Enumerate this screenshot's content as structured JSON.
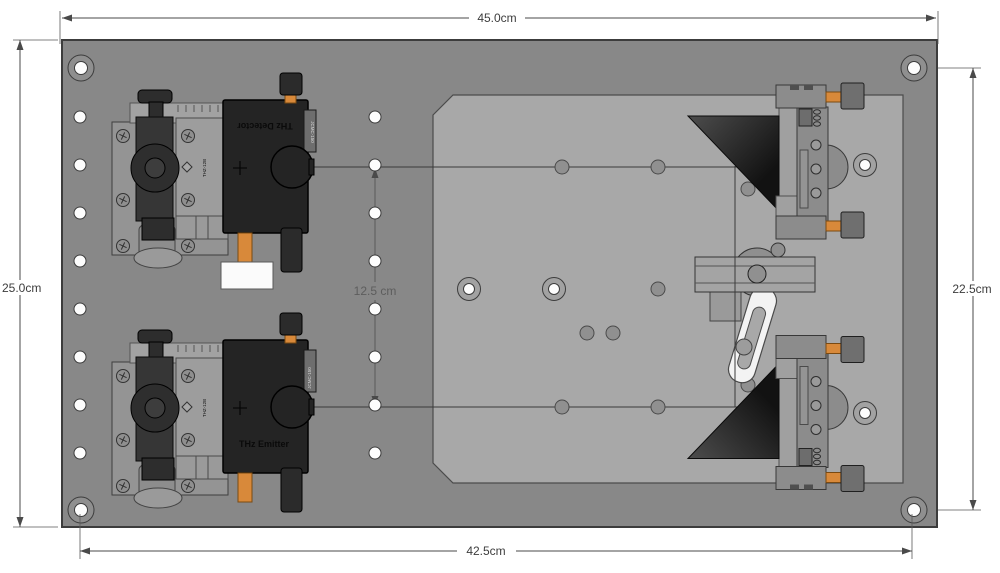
{
  "dimensions": {
    "top": "45.0cm",
    "left": "25.0cm",
    "right": "22.5cm",
    "bottom": "42.5cm",
    "beam_spacing": "12.5 cm"
  },
  "components": {
    "detector": {
      "label": "THz Detector",
      "stage_label": "THZ-12B",
      "model_label": "JCMC-150"
    },
    "emitter": {
      "label": "THz Emitter",
      "stage_label": "THZ-12B",
      "model_label": "JCMC-150"
    }
  },
  "colors": {
    "background": "#ffffff",
    "breadboard_plate": "#888888",
    "platform": "#a8a8a8",
    "dark_parts": "#242424",
    "accent_orange": "#d8893a",
    "dimension_lines": "#4a4a4a",
    "beam_line": "#3a3a3a"
  },
  "diagram": {
    "holes": [
      {
        "style": "white",
        "name": "breadboard-hole",
        "points": [
          [
            80,
            117
          ],
          [
            80,
            165
          ],
          [
            80,
            213
          ],
          [
            80,
            261
          ],
          [
            80,
            309
          ],
          [
            80,
            357
          ],
          [
            80,
            405
          ],
          [
            80,
            453
          ],
          [
            375,
            117
          ],
          [
            375,
            165
          ],
          [
            375,
            213
          ],
          [
            375,
            261
          ],
          [
            375,
            309
          ],
          [
            375,
            357
          ],
          [
            375,
            405
          ],
          [
            375,
            453
          ]
        ]
      },
      {
        "style": "corner_ring",
        "name": "corner-bolt-hole",
        "points": [
          [
            81,
            68
          ],
          [
            914,
            68
          ],
          [
            81,
            510
          ],
          [
            914,
            510
          ]
        ]
      },
      {
        "style": "platform_ring",
        "name": "platform-bolt-hole",
        "points": [
          [
            469,
            289
          ],
          [
            554,
            289
          ],
          [
            865,
            165
          ],
          [
            865,
            413
          ]
        ]
      },
      {
        "style": "dot",
        "name": "platform-hole",
        "points": [
          [
            562,
            167
          ],
          [
            658,
            167
          ],
          [
            748,
            189
          ],
          [
            658,
            289
          ],
          [
            587,
            333
          ],
          [
            613,
            333
          ],
          [
            562,
            407
          ],
          [
            658,
            407
          ],
          [
            748,
            385
          ]
        ]
      }
    ],
    "screws": [
      [
        123,
        136
      ],
      [
        188,
        136
      ],
      [
        123,
        200
      ],
      [
        188,
        200
      ],
      [
        123,
        246
      ],
      [
        188,
        246
      ],
      [
        123,
        376
      ],
      [
        188,
        376
      ],
      [
        123,
        440
      ],
      [
        188,
        440
      ],
      [
        123,
        486
      ],
      [
        188,
        486
      ]
    ]
  }
}
